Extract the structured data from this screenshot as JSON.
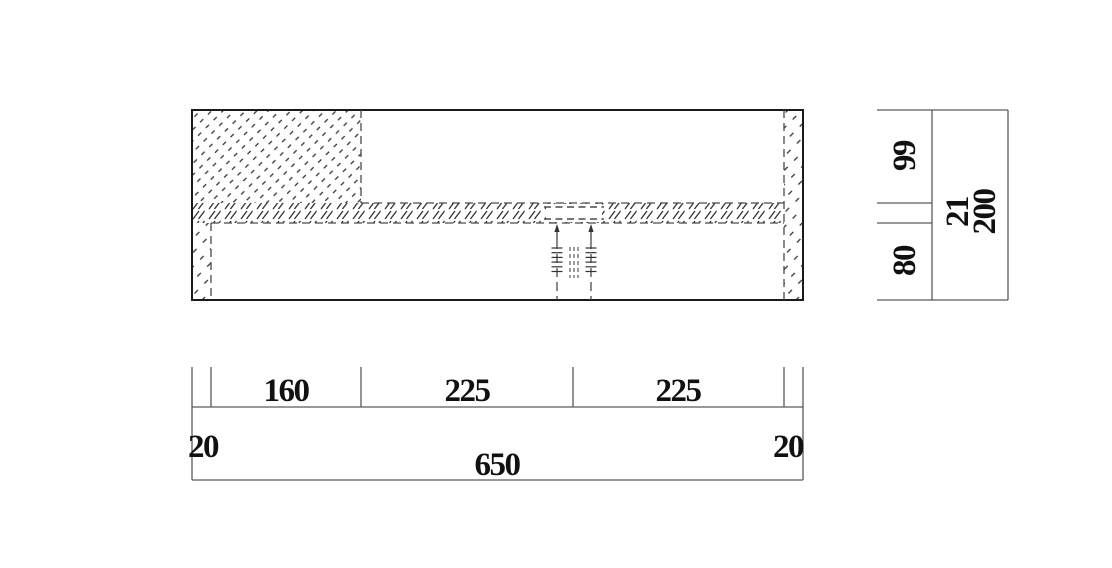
{
  "dimensions": {
    "bottom": {
      "edge_left": "20",
      "segment_1": "160",
      "segment_2": "225",
      "segment_3": "225",
      "edge_right": "20",
      "total": "650"
    },
    "side": {
      "top": "99",
      "middle": "21",
      "bottom": "80",
      "total": "200"
    }
  },
  "colors": {
    "background": "#ffffff",
    "outline": "#1a1a1a",
    "hidden_line": "#4a4a4a",
    "dimension_line": "#5a5a5a",
    "hatch": "#333333",
    "text": "#111111"
  }
}
